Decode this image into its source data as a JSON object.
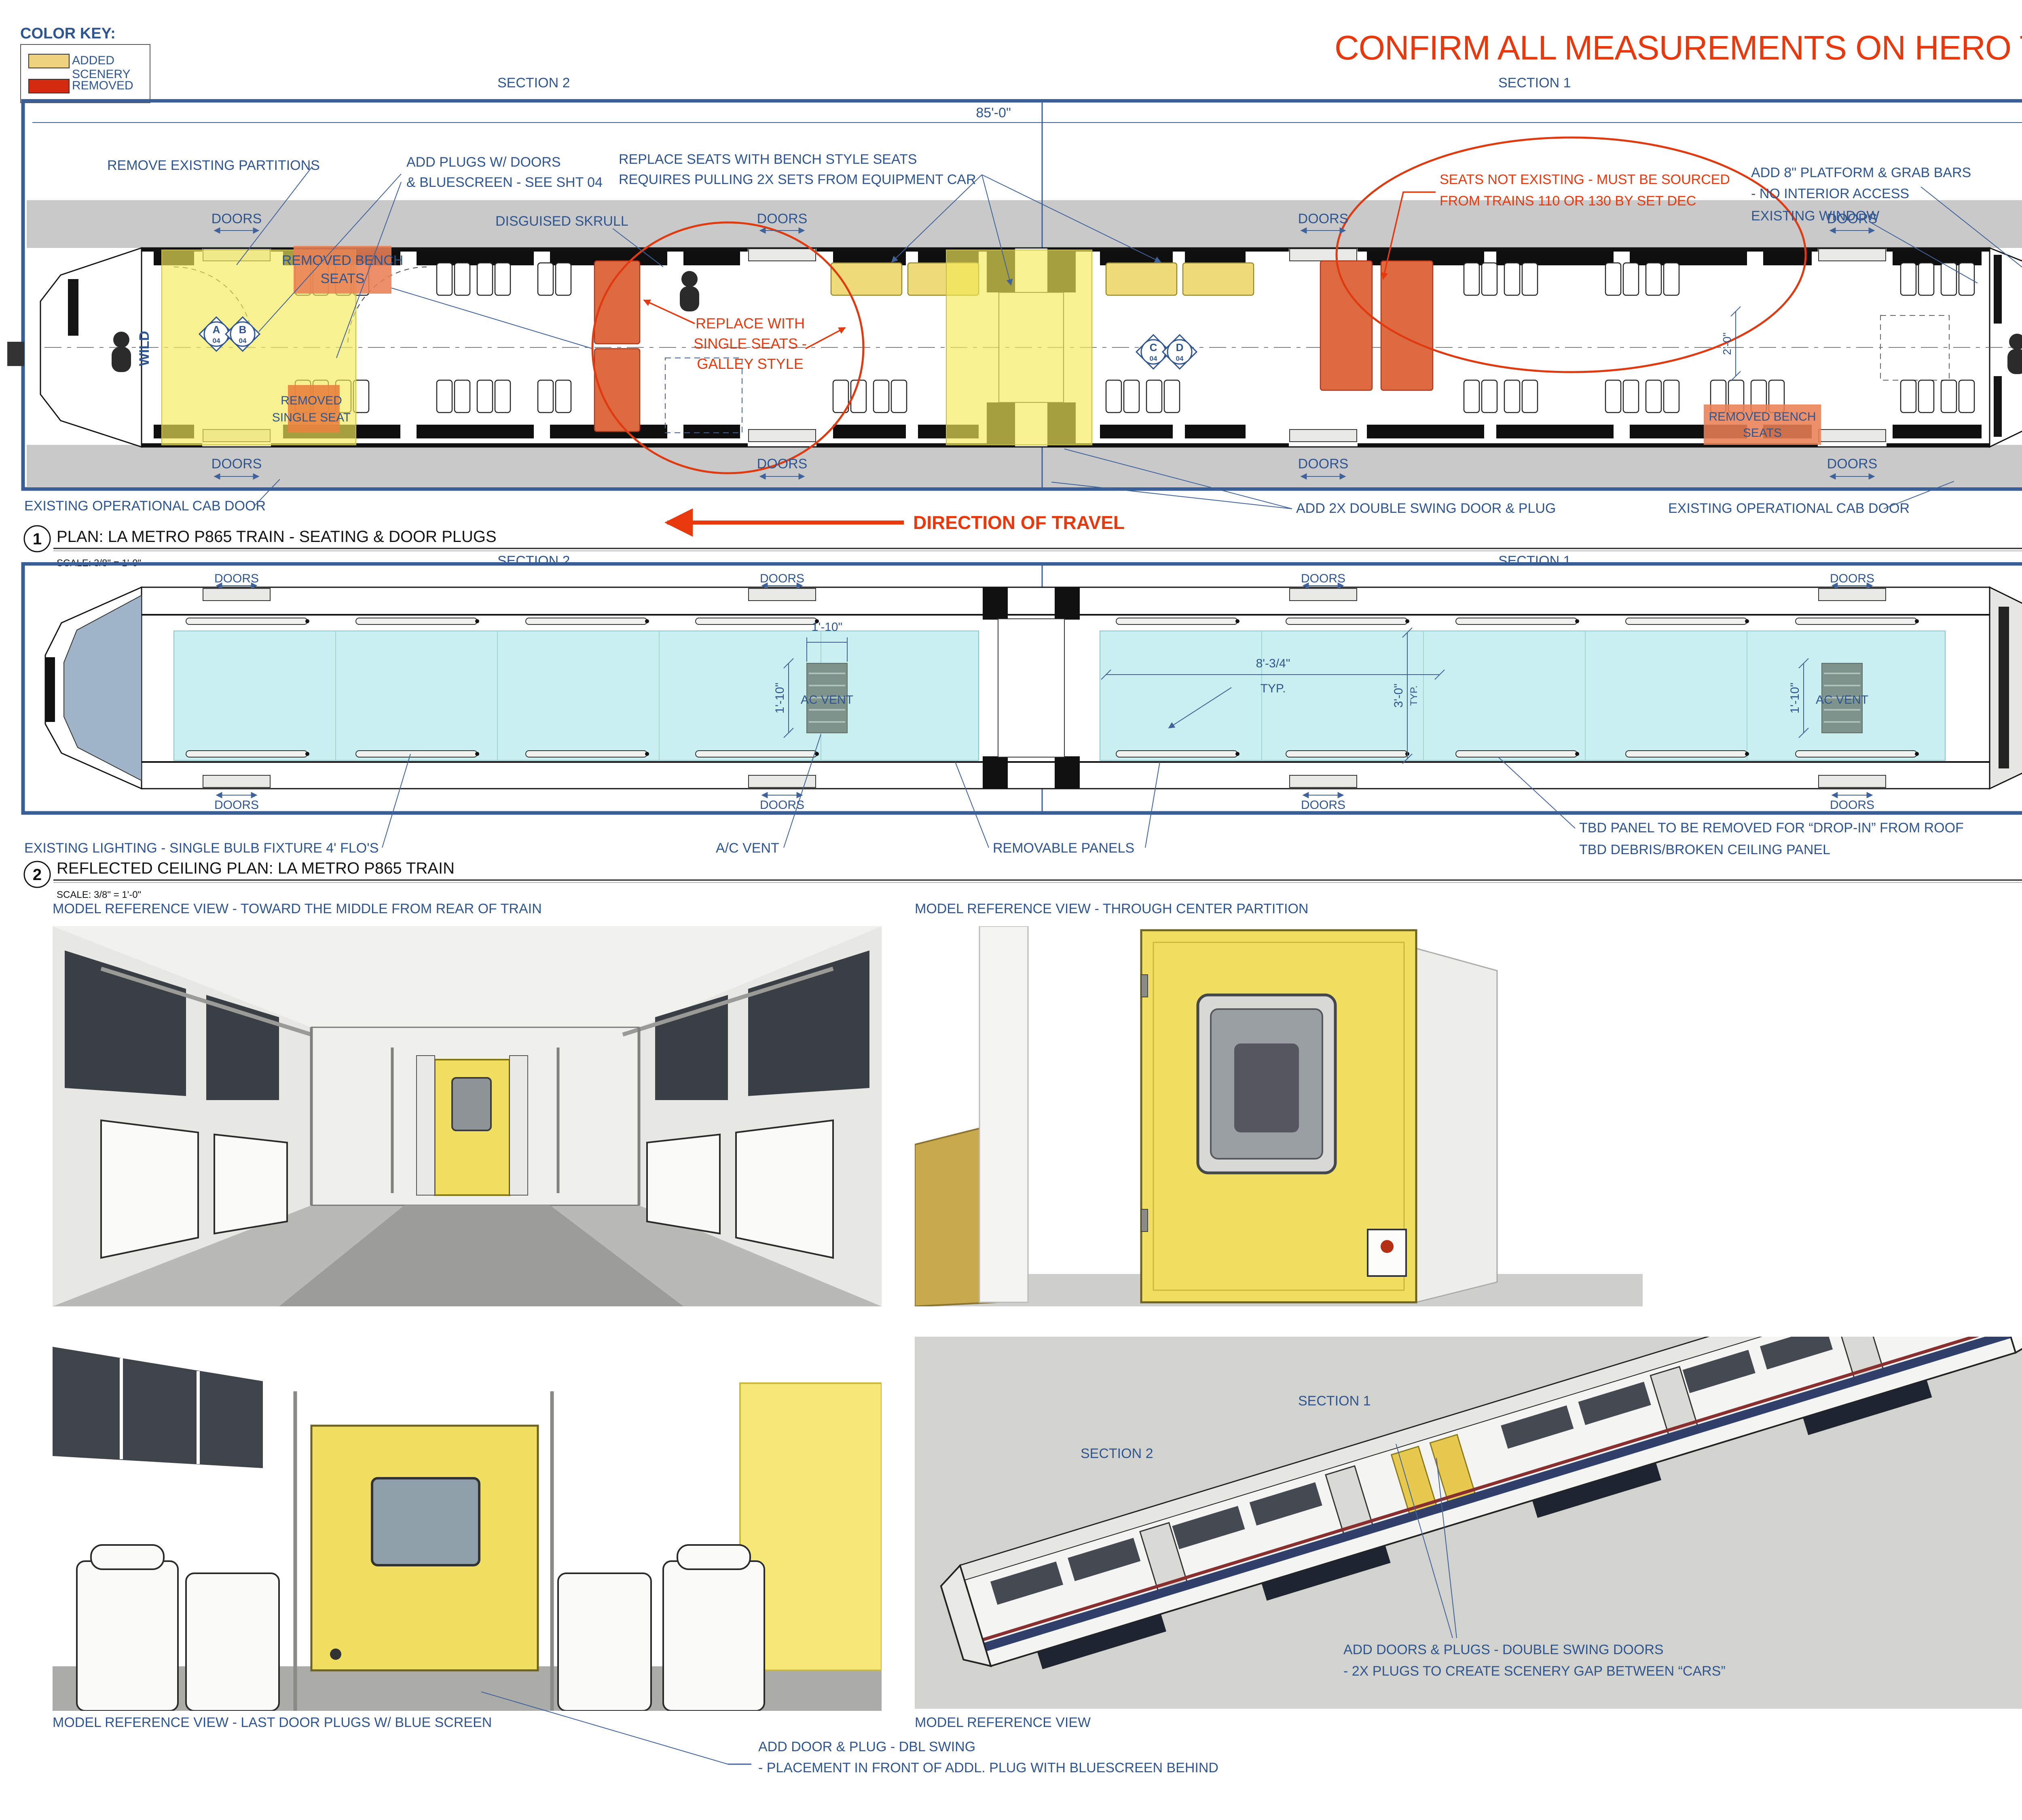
{
  "colorKey": {
    "title": "COLOR KEY:",
    "added": "ADDED SCENERY",
    "removed": "REMOVED",
    "addedColor": "#EFD27D",
    "removedColor": "#D42B10"
  },
  "warning": "CONFIRM ALL MEASUREMENTS ON HERO TRAIN BEFORE CONSTRUCTION",
  "sections": {
    "s1": "SECTION 1",
    "s2": "SECTION 2"
  },
  "doorsLabel": "DOORS",
  "plan1": {
    "dim85": "85'-0\"",
    "removePartitions": "REMOVE EXISTING PARTITIONS",
    "addPlugs1": "ADD PLUGS W/ DOORS",
    "addPlugs2": "& BLUESCREEN - SEE SHT 04",
    "replaceSeats1": "REPLACE SEATS WITH BENCH STYLE SEATS",
    "replaceSeats2": "REQUIRES PULLING 2X SETS FROM EQUIPMENT CAR",
    "skrull": "DISGUISED SKRULL",
    "seatsNot1": "SEATS NOT EXISTING - MUST BE SOURCED",
    "seatsNot2": "FROM TRAINS 110 OR 130 BY SET DEC",
    "platform1": "ADD 8\" PLATFORM & GRAB BARS",
    "platform2": "- NO INTERIOR ACCESS",
    "existingWindow": "EXISTING WINDOW",
    "removedBench1": "REMOVED BENCH",
    "removedBench2": "SEATS",
    "removedSingle1": "REMOVED",
    "removedSingle2": "SINGLE SEAT",
    "replaceSingle1": "REPLACE WITH",
    "replaceSingle2": "SINGLE SEATS -",
    "replaceSingle3": "GALLEY STYLE",
    "wild": "WILD",
    "markerA": "A",
    "markerB": "B",
    "markerC": "C",
    "markerD": "D",
    "markerSheet": "04",
    "dim26h1": "2'-6 1/2\"",
    "dim26": "2'-6\"",
    "dim26h2": "2'-6 1/2\"",
    "dim711": "7'-11\"",
    "dim20": "2'-0\"",
    "cl": "CL",
    "cabDoorLeft": "EXISTING OPERATIONAL CAB DOOR",
    "direction": "DIRECTION OF TRAVEL",
    "add2x": "ADD 2X DOUBLE SWING DOOR & PLUG",
    "cabDoorRight": "EXISTING OPERATIONAL CAB DOOR",
    "removedBenchR1": "REMOVED BENCH",
    "removedBenchR2": "SEATS"
  },
  "callout1": {
    "num": "1",
    "title": "PLAN: LA METRO P865 TRAIN - SEATING & DOOR PLUGS",
    "scale": "SCALE: 3/8\" = 1'-0\""
  },
  "plan2": {
    "dim110": "1'-10\"",
    "acVent": "AC VENT",
    "dim834": "8'-3/4\"",
    "typ": "TYP.",
    "dim30": "3'-0\"",
    "lighting": "EXISTING LIGHTING - SINGLE BULB FIXTURE 4' FLO'S",
    "acVentNote": "A/C VENT",
    "removablePanels": "REMOVABLE PANELS",
    "tbd1": "TBD PANEL TO BE REMOVED FOR “DROP-IN” FROM ROOF",
    "tbd2": "TBD DEBRIS/BROKEN CEILING PANEL"
  },
  "callout2": {
    "num": "2",
    "title": "REFLECTED CEILING PLAN: LA METRO P865 TRAIN",
    "scale": "SCALE: 3/8\" = 1'-0\""
  },
  "views": {
    "v1": "MODEL REFERENCE VIEW - TOWARD THE MIDDLE FROM REAR OF TRAIN",
    "v2": "MODEL REFERENCE VIEW - THROUGH CENTER PARTITION",
    "v3": "MODEL REFERENCE VIEW - LAST DOOR PLUGS W/ BLUE SCREEN",
    "v4": "MODEL REFERENCE VIEW",
    "isoNote1": "ADD DOORS & PLUGS - DOUBLE SWING DOORS",
    "isoNote2": "- 2X PLUGS TO CREATE SCENERY GAP BETWEEN “CARS”",
    "note1": "ADD DOOR & PLUG - DBL SWING",
    "note2": "- PLACEMENT IN FRONT OF ADDL. PLUG WITH BLUESCREEN BEHIND"
  },
  "revised": {
    "stamp": "REVISED",
    "date": "03/05/18"
  },
  "titleblock": {
    "logo": "OPEN WORLD",
    "credits": [
      "Directors:  ANNA BODEN, RYAN FLECK",
      "Executive Producer:  JONATHAN SCHWARTZ",
      "Executive Producer:  PATRICIA WHITCHER",
      "Production Designer:  ANDY NICHOLSON"
    ],
    "setNameLabel": "SET NAME:",
    "setName": "1023-1026 METRO STATION & TRAIN",
    "sheetTitleLabel": "SHEET TITLE:",
    "sheetTitle": "INTERIOR PLAN & VIEWS",
    "scaleLabel": "SCALE:",
    "scale": "3/8\" = 1'-0\"",
    "stageLabel": "STAGE/LOC:",
    "stage": "VARIOUS",
    "dateIssuedLabel": "DATE ISSUED:",
    "dateIssued": "02/16/18",
    "dateDrawnLabel": "DATE DRAWN:",
    "dateDrawn": "02/16/18",
    "drawnByLabel": "DRAWN BY:",
    "drawnBy": "MBG",
    "revisionLabel": "REVISION DATE:",
    "revisionDate": "03/05/18",
    "setNoLabel": "SET NO - SHEET",
    "setNo": "1025A-B-",
    "sheetNum": "03",
    "ofLabel": "OF:",
    "fileLabel": "FILE NAME:",
    "fileName": "1025A-B-03_Subway_IE_180305_IntTrainPlans_v001_MBG",
    "approvalsLabel": "APPROVALS",
    "approvalCols": [
      "PRODUCER",
      "DIRECTOR",
      "UPM",
      "PRODUCTION DESIGNER",
      "STUDIO EXEC.",
      "CONST. COORDINATOR"
    ]
  }
}
